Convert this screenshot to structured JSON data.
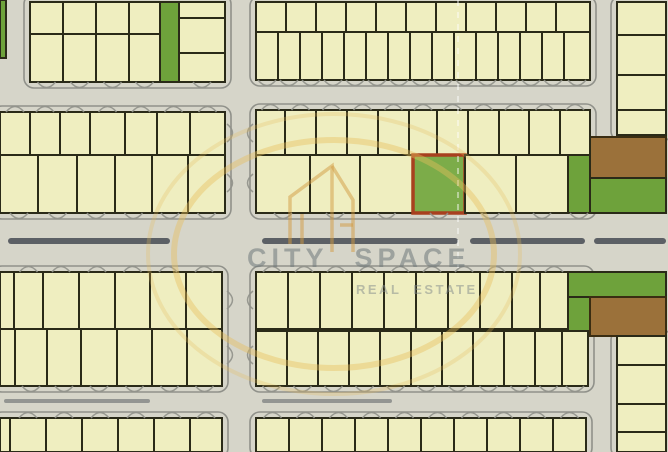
{
  "watermark": {
    "title": "CITY SPACE",
    "subtitle": "REAL ESTATE",
    "ring_color": "#e6be5c",
    "logo_color": "#d29a3f",
    "rings": [
      {
        "cx": 334,
        "cy": 254,
        "rx": 160,
        "ry": 114,
        "w": 6,
        "op": 0.42
      },
      {
        "cx": 334,
        "cy": 254,
        "rx": 186,
        "ry": 140,
        "w": 4,
        "op": 0.27
      }
    ],
    "logo_paths": [
      "M290,244 L290,197 L332,166 L332,252",
      "M302,244 L302,214",
      "M353,252 L353,200 L332,166",
      "M340,225 L353,225"
    ]
  },
  "colors": {
    "road_bg": "#d6d5c9",
    "curb": "#90918a",
    "plot_fill": "#efeec0",
    "plot_border": "#2a2a18",
    "green": "#6ea23b",
    "brown": "#9b713a",
    "brown_border": "#3a2d12",
    "highlight_fill": "#7cac49",
    "highlight_border": "#a8401f",
    "median": "#5c6065",
    "crease": "#ffffff"
  },
  "map": {
    "width": 668,
    "height": 452,
    "curbs": [
      {
        "x0": 24,
        "y0": -6,
        "x1": 231,
        "y1": 88
      },
      {
        "x0": 250,
        "y0": -4,
        "x1": 596,
        "y1": 86
      },
      {
        "x0": 611,
        "y0": -4,
        "x1": 672,
        "y1": 141
      },
      {
        "x0": -8,
        "y0": 106,
        "x1": 231,
        "y1": 219
      },
      {
        "x0": 250,
        "y0": 104,
        "x1": 596,
        "y1": 219
      },
      {
        "x0": -8,
        "y0": 266,
        "x1": 228,
        "y1": 392
      },
      {
        "x0": 250,
        "y0": 266,
        "x1": 594,
        "y1": 392
      },
      {
        "x0": -8,
        "y0": 412,
        "x1": 228,
        "y1": 458
      },
      {
        "x0": 250,
        "y0": 412,
        "x1": 592,
        "y1": 458
      },
      {
        "x0": 611,
        "y0": 330,
        "x1": 672,
        "y1": 458
      }
    ],
    "medians": [
      {
        "y": 238,
        "h": 6,
        "segments": [
          [
            8,
            170
          ],
          [
            262,
            458
          ],
          [
            470,
            585
          ],
          [
            594,
            666
          ]
        ],
        "op": 1
      },
      {
        "y": 399,
        "h": 4,
        "segments": [
          [
            4,
            150
          ],
          [
            262,
            392
          ]
        ],
        "op": 0.55
      }
    ],
    "features": [
      {
        "name": "green-sliver",
        "x0": 0,
        "y0": 0,
        "x1": 6,
        "y1": 58,
        "fill": "green"
      },
      {
        "name": "green-strip",
        "x0": 160,
        "y0": 2,
        "x1": 179,
        "y1": 82,
        "fill": "green"
      },
      {
        "name": "brown-plot-upper",
        "x0": 590,
        "y0": 137,
        "x1": 666,
        "y1": 178,
        "fill": "brown"
      },
      {
        "name": "green-area-upper",
        "x0": 590,
        "y0": 178,
        "x1": 666,
        "y1": 213,
        "fill": "green"
      },
      {
        "name": "green-area-lower-top",
        "x0": 568,
        "y0": 272,
        "x1": 666,
        "y1": 297,
        "fill": "green"
      },
      {
        "name": "green-area-lower-strip",
        "x0": 568,
        "y0": 297,
        "x1": 590,
        "y1": 331,
        "fill": "green"
      },
      {
        "name": "brown-plot-lower",
        "x0": 590,
        "y0": 297,
        "x1": 666,
        "y1": 336,
        "fill": "brown"
      }
    ],
    "blocks": [
      {
        "id": "top-left",
        "arcs": [
          "bottom"
        ],
        "rows": [
          {
            "y0": 2,
            "y1": 34,
            "cols": [
              30,
              63,
              96,
              129,
              160
            ]
          },
          {
            "y0": 34,
            "y1": 82,
            "cols": [
              30,
              63,
              96,
              129,
              160
            ]
          }
        ]
      },
      {
        "id": "top-left-east",
        "arcs": [
          "bottom"
        ],
        "rows": [
          {
            "y0": 2,
            "y1": 18,
            "cols": [
              179,
              225
            ]
          },
          {
            "y0": 18,
            "y1": 53,
            "cols": [
              179,
              225
            ]
          },
          {
            "y0": 53,
            "y1": 82,
            "cols": [
              179,
              225
            ]
          }
        ]
      },
      {
        "id": "top-center",
        "arcs": [
          "bottom"
        ],
        "rows": [
          {
            "y0": 2,
            "y1": 32,
            "cols": [
              256,
              286,
              316,
              346,
              376,
              406,
              436,
              466,
              496,
              526,
              556,
              590
            ]
          },
          {
            "y0": 32,
            "y1": 80,
            "cols": [
              256,
              278,
              300,
              322,
              344,
              366,
              388,
              410,
              432,
              454,
              476,
              498,
              520,
              542,
              564,
              590
            ]
          }
        ]
      },
      {
        "id": "top-right-edge",
        "arcs": [],
        "rows": [
          {
            "y0": 2,
            "y1": 35,
            "cols": [
              617,
              666
            ]
          },
          {
            "y0": 35,
            "y1": 75,
            "cols": [
              617,
              666
            ]
          },
          {
            "y0": 75,
            "y1": 110,
            "cols": [
              617,
              666
            ]
          },
          {
            "y0": 110,
            "y1": 135,
            "cols": [
              617,
              666
            ]
          }
        ]
      },
      {
        "id": "mid-left",
        "arcs": [
          "top",
          "bottom"
        ],
        "rows": [
          {
            "y0": 112,
            "y1": 155,
            "cols": [
              0,
              30,
              60,
              90,
              125,
              157,
              190,
              225
            ]
          },
          {
            "y0": 155,
            "y1": 213,
            "cols": [
              0,
              38,
              77,
              115,
              152,
              188,
              225
            ]
          }
        ]
      },
      {
        "id": "mid-center",
        "arcs": [
          "top",
          "bottom"
        ],
        "rows": [
          {
            "y0": 110,
            "y1": 155,
            "cols": [
              256,
              285,
              316,
              347,
              378,
              409,
              437,
              468,
              499,
              529,
              560,
              590
            ]
          },
          {
            "y0": 155,
            "y1": 213,
            "plots": [
              {
                "x0": 256,
                "x1": 310
              },
              {
                "x0": 310,
                "x1": 360
              },
              {
                "x0": 360,
                "x1": 413
              },
              {
                "x0": 413,
                "x1": 465,
                "fill": "highlight"
              },
              {
                "x0": 465,
                "x1": 516
              },
              {
                "x0": 516,
                "x1": 568
              },
              {
                "x0": 568,
                "x1": 590,
                "fill": "green"
              }
            ]
          }
        ]
      },
      {
        "id": "low-left",
        "arcs": [
          "top",
          "bottom"
        ],
        "rows": [
          {
            "y0": 272,
            "y1": 329,
            "cols": [
              0,
              14,
              43,
              79,
              115,
              150,
              186,
              222
            ]
          },
          {
            "y0": 329,
            "y1": 386,
            "cols": [
              0,
              15,
              47,
              81,
              117,
              152,
              187,
              222
            ]
          }
        ]
      },
      {
        "id": "low-center",
        "arcs": [
          "top",
          "bottom"
        ],
        "rows": [
          {
            "y0": 272,
            "y1": 329,
            "cols": [
              256,
              288,
              320,
              352,
              384,
              416,
              448,
              480,
              512,
              540,
              568
            ]
          },
          {
            "y0": 331,
            "y1": 386,
            "cols": [
              256,
              287,
              318,
              349,
              380,
              411,
              442,
              473,
              504,
              535,
              562,
              588
            ]
          }
        ]
      },
      {
        "id": "low-right-edge",
        "arcs": [],
        "rows": [
          {
            "y0": 336,
            "y1": 365,
            "cols": [
              617,
              666
            ]
          },
          {
            "y0": 365,
            "y1": 404,
            "cols": [
              617,
              666
            ]
          },
          {
            "y0": 404,
            "y1": 432,
            "cols": [
              617,
              666
            ]
          },
          {
            "y0": 432,
            "y1": 452,
            "cols": [
              617,
              666
            ]
          }
        ]
      },
      {
        "id": "bottom-left",
        "arcs": [
          "top"
        ],
        "rows": [
          {
            "y0": 418,
            "y1": 452,
            "cols": [
              0,
              10,
              46,
              82,
              118,
              154,
              190,
              222
            ]
          }
        ]
      },
      {
        "id": "bottom-center",
        "arcs": [
          "top"
        ],
        "rows": [
          {
            "y0": 418,
            "y1": 452,
            "cols": [
              256,
              289,
              322,
              355,
              388,
              421,
              454,
              487,
              520,
              553,
              586
            ]
          }
        ]
      }
    ],
    "varcs": [
      {
        "x": 227,
        "dir": 1,
        "ys": [
          133,
          183,
          300,
          355
        ]
      },
      {
        "x": 253,
        "dir": -1,
        "ys": [
          133,
          183,
          300,
          355
        ]
      }
    ],
    "crease": {
      "x": 458,
      "y0": 0,
      "y1": 268
    }
  }
}
